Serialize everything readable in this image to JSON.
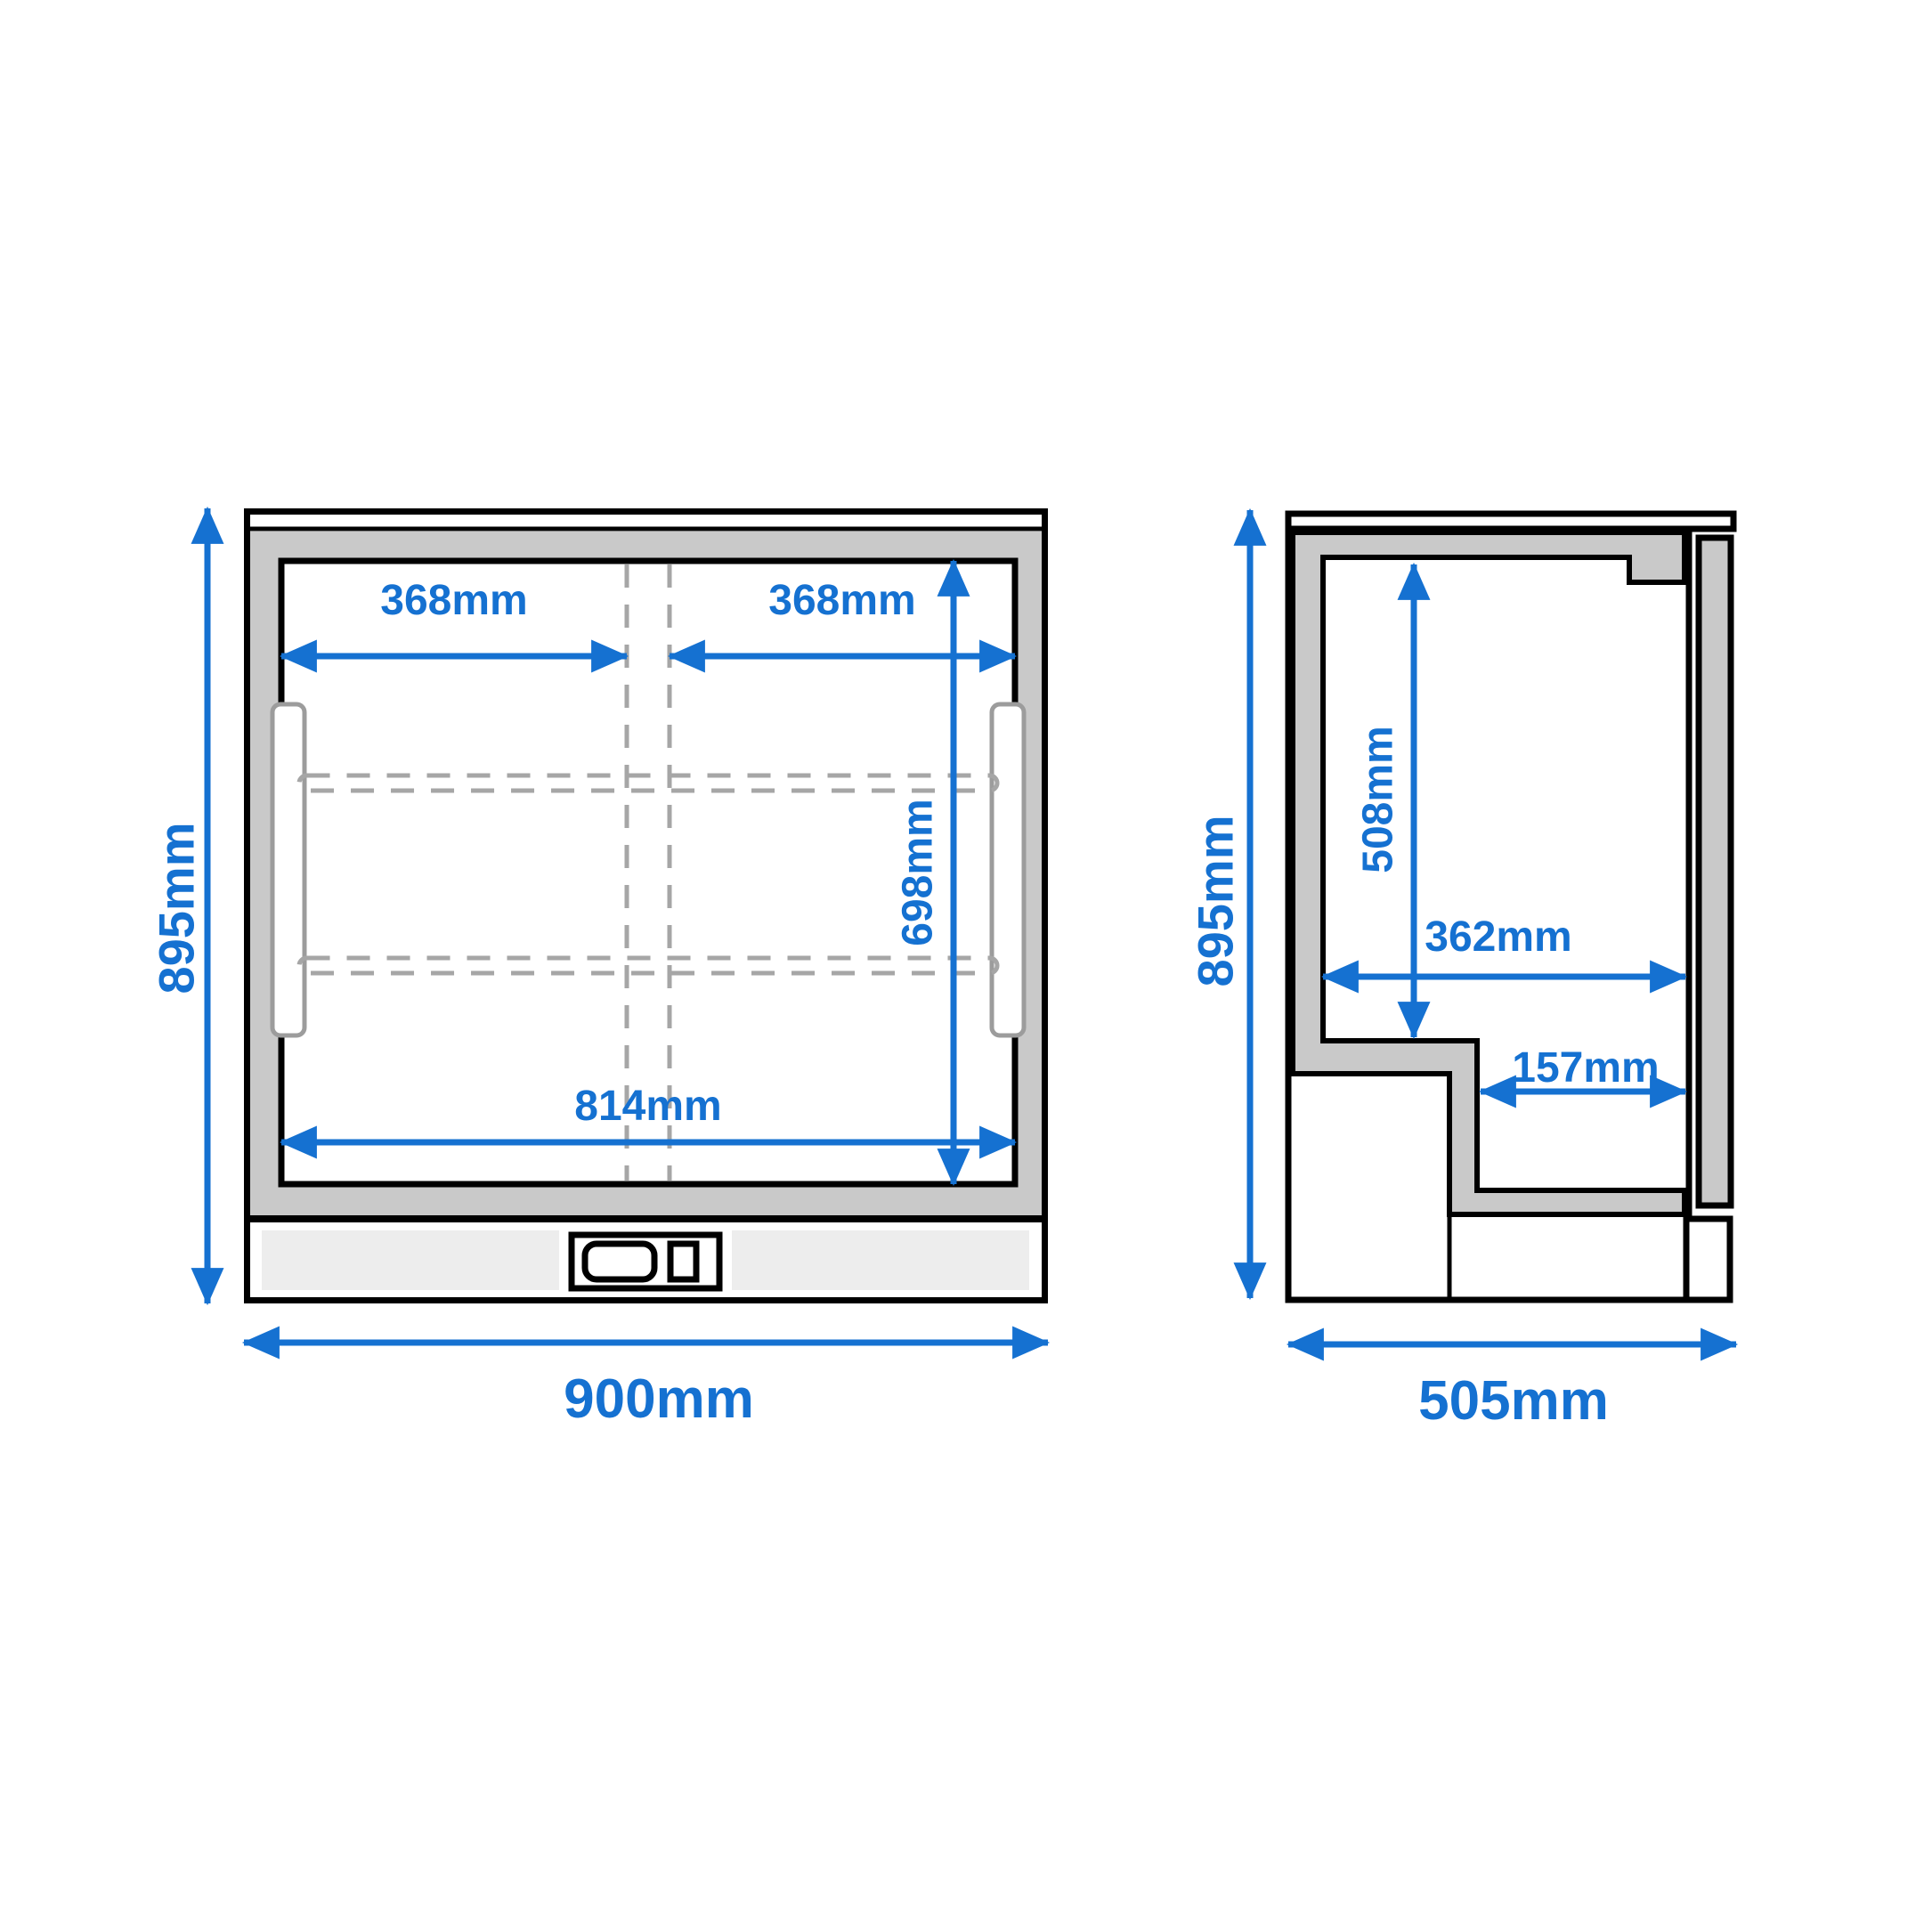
{
  "diagram_title": "Bar cooler dimension drawing",
  "colors": {
    "dimension_blue": "#1571d1",
    "frame_gray": "#c9c9c9",
    "outline_black": "#000000",
    "dash_gray": "#a6a6a6",
    "vent_gray": "#ededed"
  },
  "front_view": {
    "dimensions": {
      "left_door_width": "368mm",
      "right_door_width": "368mm",
      "interior_height": "698mm",
      "interior_width": "814mm",
      "overall_height": "895mm",
      "overall_width": "900mm"
    }
  },
  "side_view": {
    "dimensions": {
      "overall_height": "895mm",
      "interior_height": "508mm",
      "interior_depth": "362mm",
      "recess_depth": "157mm",
      "overall_depth": "505mm"
    }
  }
}
